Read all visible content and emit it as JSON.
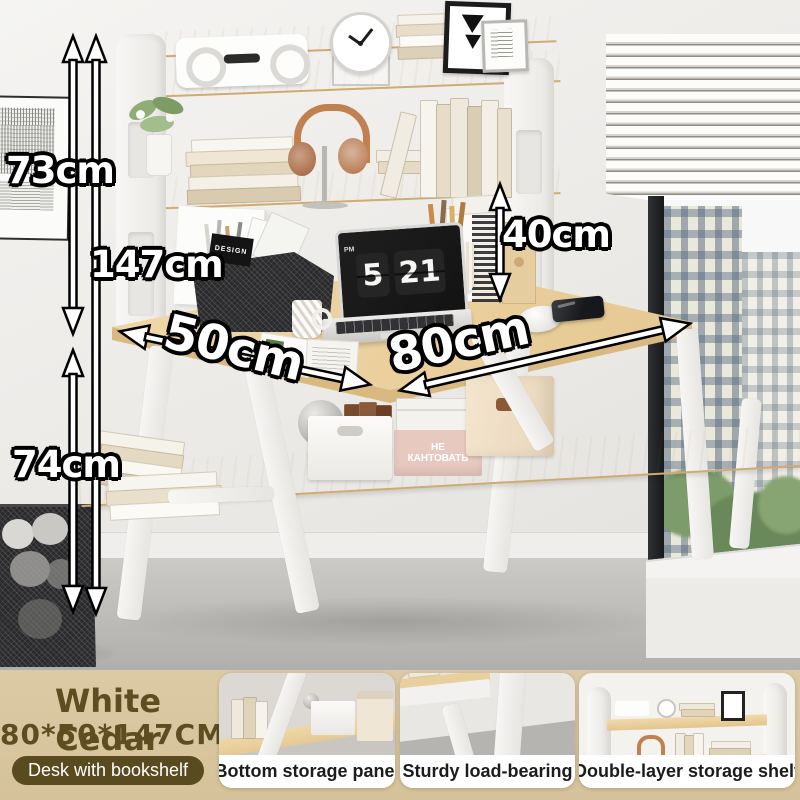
{
  "annotations": {
    "hutch_height": "73cm",
    "total_height": "147cm",
    "shelf_clearance": "40cm",
    "desk_height": "74cm",
    "desk_depth": "50cm",
    "desk_width": "80cm"
  },
  "desk_scene": {
    "laptop_clock_hour": "5",
    "laptop_clock_minute": "21",
    "laptop_clock_meridiem": "PM",
    "storage_box_text": "НЕ КАНТОВАТЬ",
    "organizer_card_text": "DESIGN"
  },
  "footer": {
    "product_name": "White Cedar",
    "product_size": "80*50*147CM",
    "product_tag": "Desk with bookshelf",
    "features": [
      {
        "label": "Bottom storage panel"
      },
      {
        "label": "Sturdy load-bearing"
      },
      {
        "label": "Double-layer storage shelf"
      }
    ]
  },
  "colors": {
    "wood": "#ecd2a0",
    "frame_white": "#f4f3f1",
    "wall": "#edebe8",
    "floor": "#c2c0bd",
    "footer_background": "#d9c7a0",
    "footer_text": "#5d4d20",
    "tag_background": "#5a4a20",
    "tag_text": "#ffffff",
    "annotation_fill": "#ffffff",
    "annotation_outline": "#000000",
    "card_label_text": "#1c1c1c"
  }
}
